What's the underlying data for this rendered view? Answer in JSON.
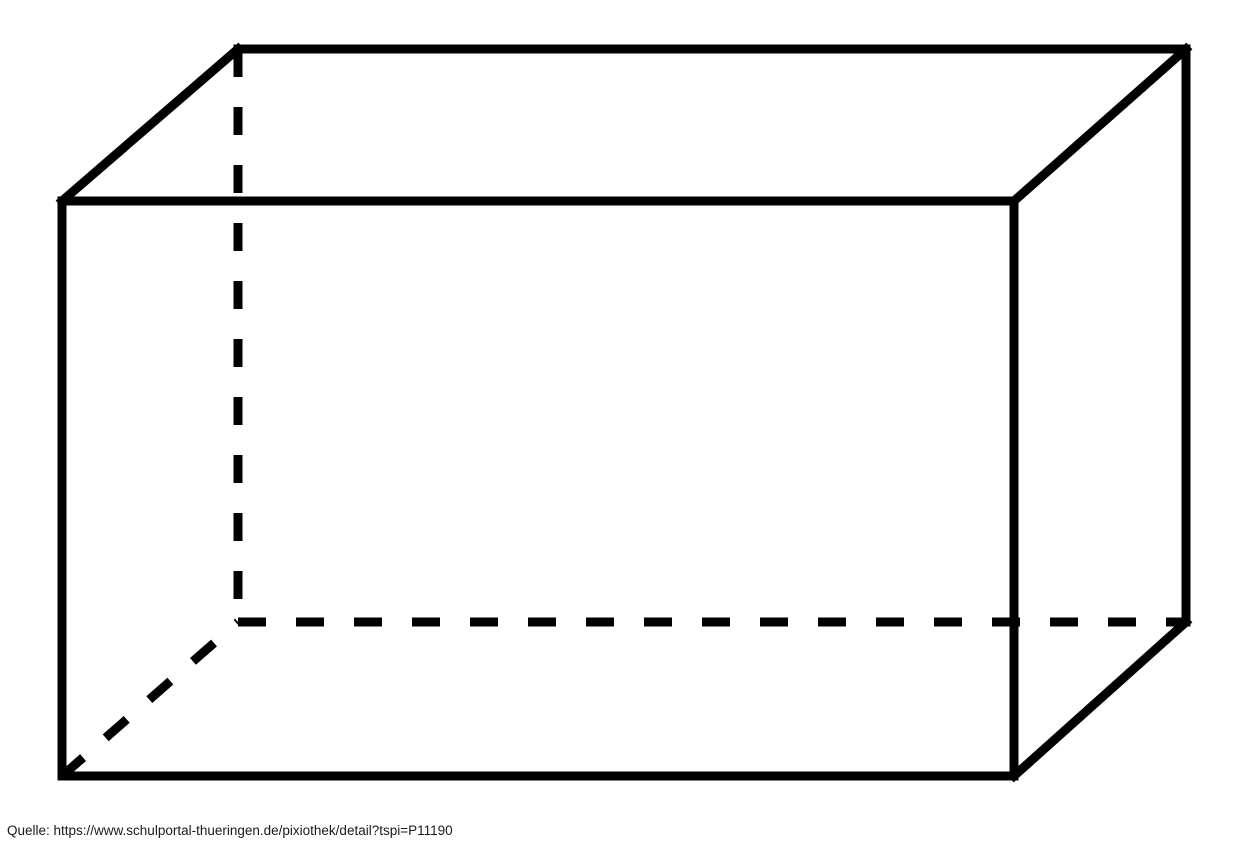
{
  "page": {
    "background_color": "#ffffff"
  },
  "caption": {
    "text": "Quelle: https://www.schulportal-thueringen.de/pixiothek/detail?tspi=P11190",
    "color": "#1a1a1a"
  },
  "diagram": {
    "type": "cuboid-wireframe",
    "description": "rectangular prism (Quader) wireframe, hidden edges dashed",
    "stroke_color": "#000000",
    "stroke_width": 9,
    "dash_pattern": "28 30",
    "canvas": {
      "width": 1250,
      "height": 845
    },
    "vertices": {
      "front_top_left": [
        62,
        201
      ],
      "front_top_right": [
        1014,
        201
      ],
      "front_bottom_right": [
        1014,
        776
      ],
      "front_bottom_left": [
        62,
        776
      ],
      "back_top_left": [
        238,
        49
      ],
      "back_top_right": [
        1186,
        49
      ],
      "back_bottom_right": [
        1186,
        622
      ],
      "back_bottom_left": [
        238,
        622
      ]
    },
    "edges": [
      {
        "from": "front_top_left",
        "to": "front_top_right",
        "style": "solid"
      },
      {
        "from": "front_top_right",
        "to": "front_bottom_right",
        "style": "solid"
      },
      {
        "from": "front_bottom_right",
        "to": "front_bottom_left",
        "style": "solid"
      },
      {
        "from": "front_bottom_left",
        "to": "front_top_left",
        "style": "solid"
      },
      {
        "from": "back_top_left",
        "to": "back_top_right",
        "style": "solid"
      },
      {
        "from": "front_top_left",
        "to": "back_top_left",
        "style": "solid"
      },
      {
        "from": "front_top_right",
        "to": "back_top_right",
        "style": "solid"
      },
      {
        "from": "back_top_right",
        "to": "back_bottom_right",
        "style": "solid"
      },
      {
        "from": "front_bottom_right",
        "to": "back_bottom_right",
        "style": "solid"
      },
      {
        "from": "back_top_left",
        "to": "back_bottom_left",
        "style": "dashed"
      },
      {
        "from": "back_bottom_left",
        "to": "back_bottom_right",
        "style": "dashed"
      },
      {
        "from": "front_bottom_left",
        "to": "back_bottom_left",
        "style": "dashed"
      }
    ]
  }
}
